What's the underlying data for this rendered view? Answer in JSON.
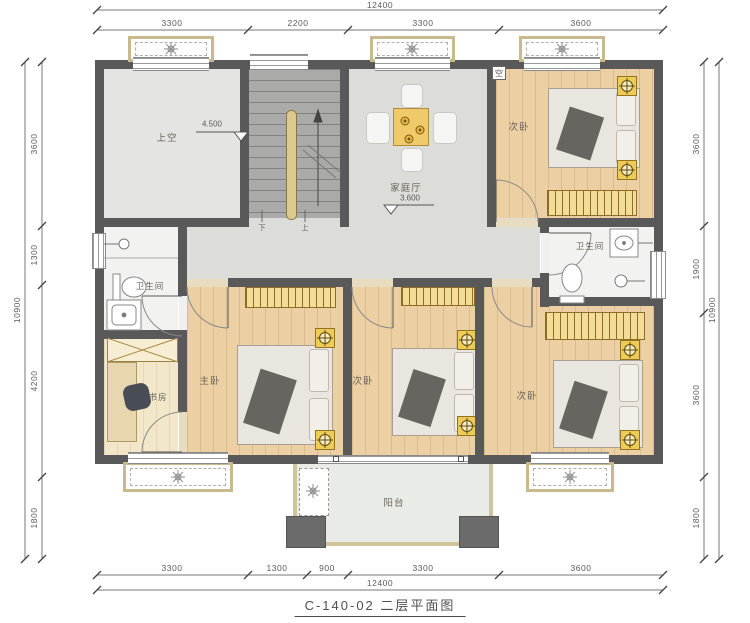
{
  "title": "C-140-02 二层平面图",
  "dimensions": {
    "top": {
      "total": "12400",
      "segments": [
        "3300",
        "2200",
        "3300",
        "3600"
      ]
    },
    "bottom": {
      "total": "12400",
      "segments": [
        "3300",
        "1300",
        "900",
        "3300",
        "3600"
      ]
    },
    "left": {
      "total": "10900",
      "segments": [
        "3600",
        "1300",
        "4200",
        "1800"
      ]
    },
    "right": {
      "total": "10900",
      "segments": [
        "3600",
        "1900",
        "3600",
        "1800"
      ]
    }
  },
  "rooms": {
    "void": {
      "label": "上空",
      "level": "4.500"
    },
    "family_hall": {
      "label": "家庭厅",
      "level": "3.600"
    },
    "bedroom_top_right": {
      "label": "次卧"
    },
    "bathroom_left": {
      "label": "卫生间"
    },
    "bathroom_right": {
      "label": "卫生间"
    },
    "study": {
      "label": "书房"
    },
    "master_bedroom": {
      "label": "主卧"
    },
    "bedroom_middle": {
      "label": "次卧"
    },
    "bedroom_bottom_right": {
      "label": "次卧"
    },
    "balcony": {
      "label": "阳台"
    }
  },
  "stair": {
    "down_label": "下",
    "up_label": "上"
  },
  "ac_label": "空",
  "colors": {
    "wall": "#595959",
    "wood_floor": "#eccfa3",
    "cabinet": "#f3dc96",
    "accent": "#eecb55"
  }
}
